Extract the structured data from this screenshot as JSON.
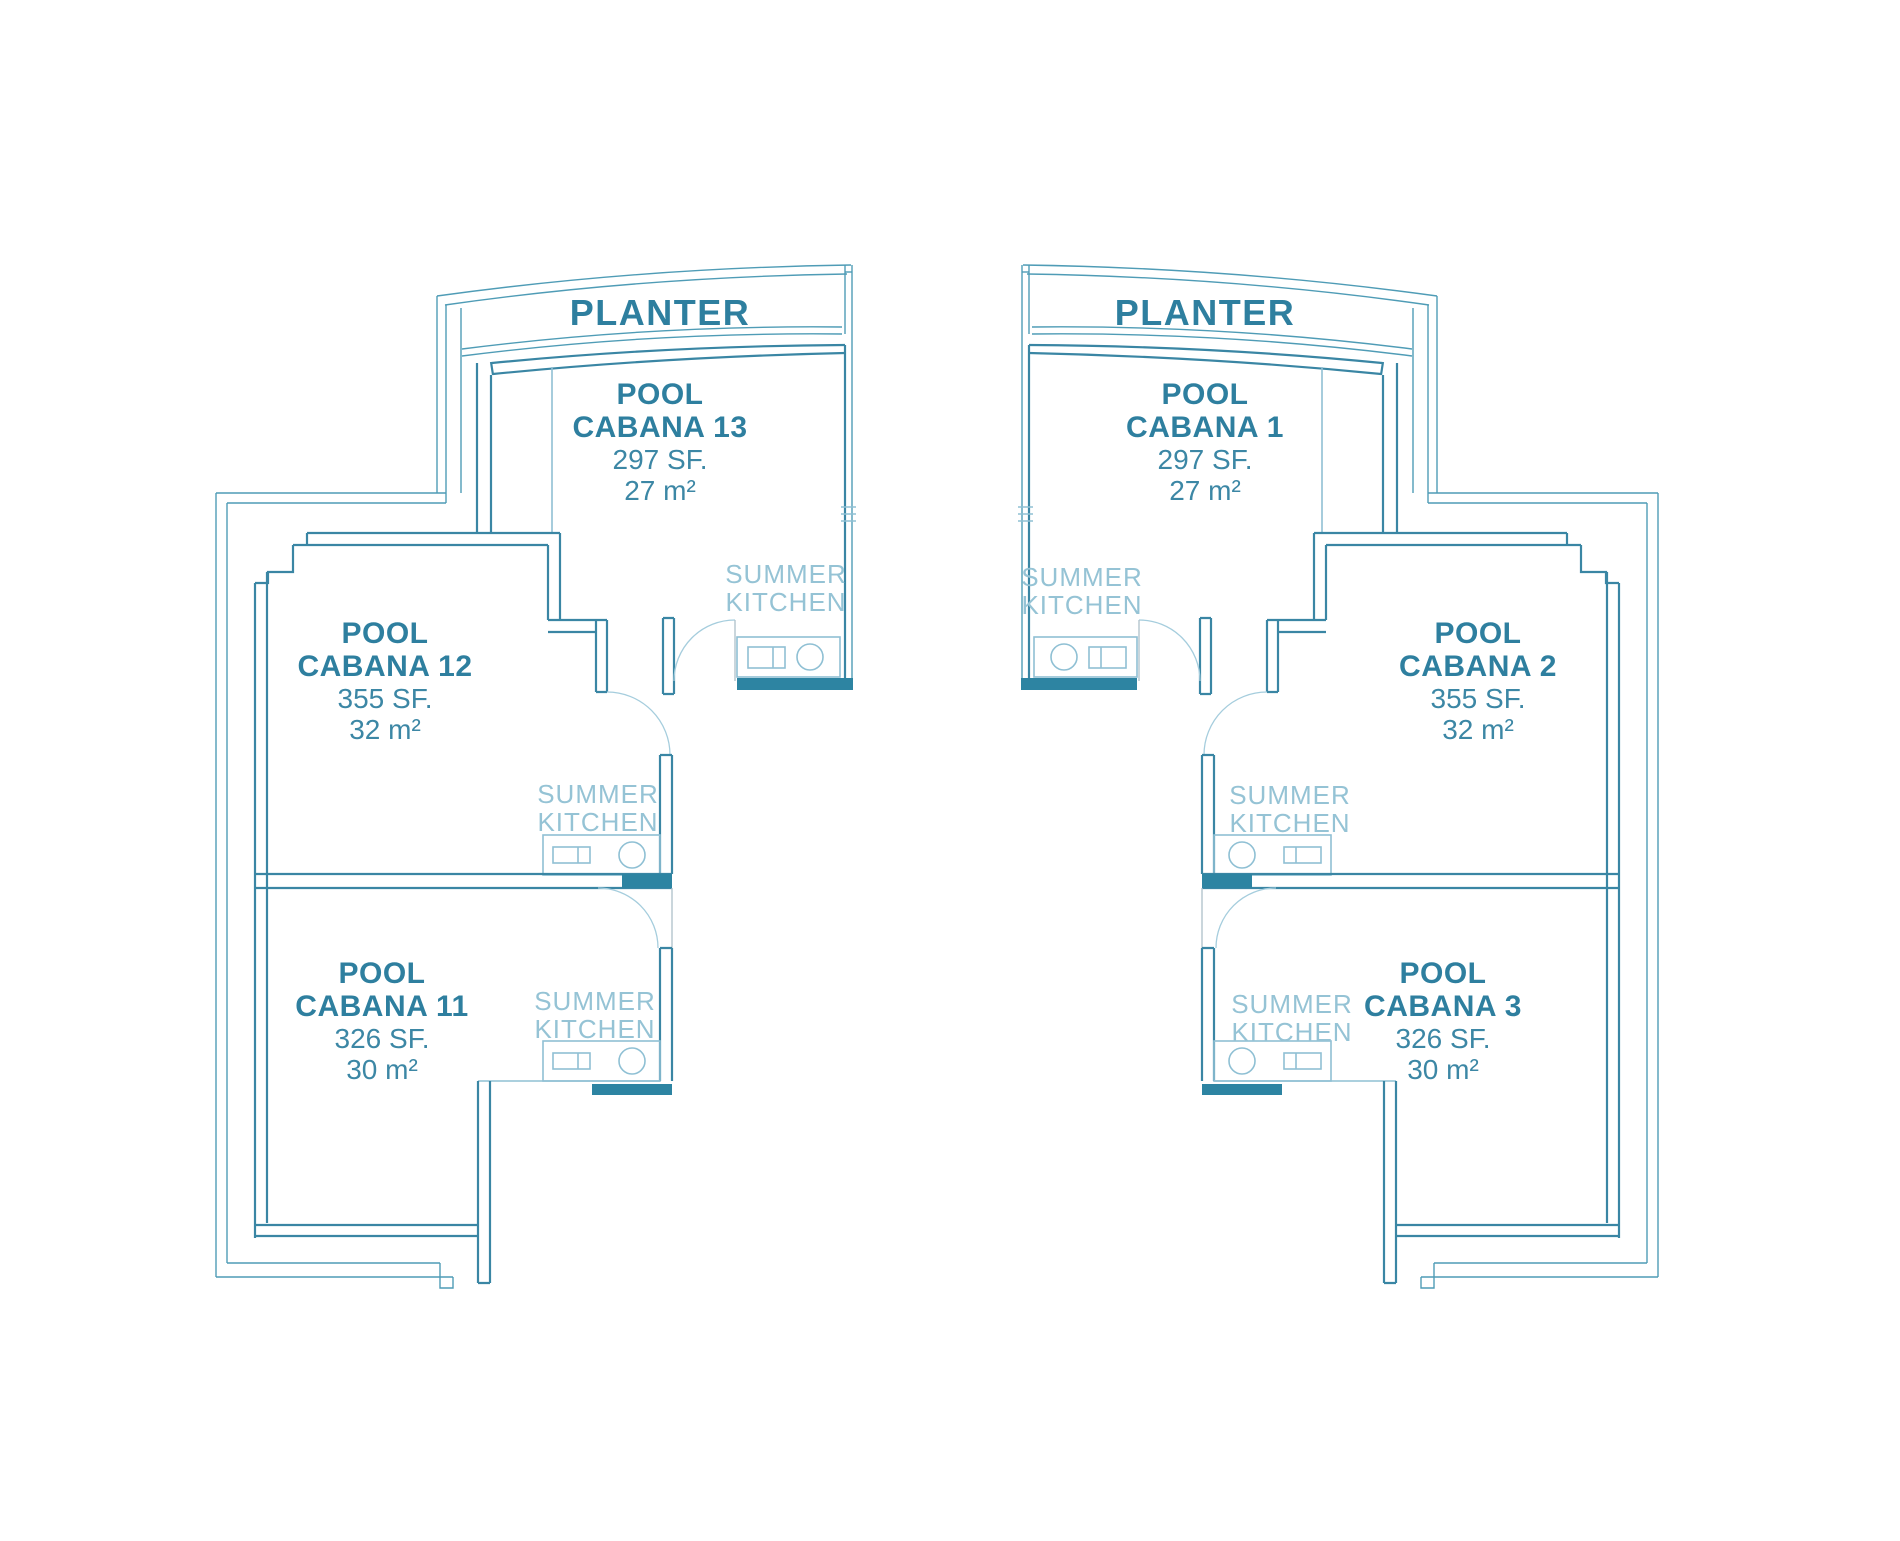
{
  "colors": {
    "wall": "#3a86a4",
    "wall_dark_fill": "#2d84a2",
    "outer_boundary": "#4f9cb6",
    "fixture_light": "#8fc0d4",
    "door_arc": "#a5cddd",
    "label_bold": "#2e7f9f",
    "label_number": "#3c87a5",
    "label_kitchen": "#95c3d5",
    "background": "#ffffff"
  },
  "summer_kitchen": {
    "line1": "SUMMER",
    "line2": "KITCHEN"
  },
  "plans": {
    "left": {
      "planter": "PLANTER",
      "cabanas": [
        {
          "line1": "POOL",
          "line2": "CABANA 13",
          "sf": "297 SF.",
          "m2": "27 m²"
        },
        {
          "line1": "POOL",
          "line2": "CABANA 12",
          "sf": "355 SF.",
          "m2": "32 m²"
        },
        {
          "line1": "POOL",
          "line2": "CABANA 11",
          "sf": "326 SF.",
          "m2": "30 m²"
        }
      ]
    },
    "right": {
      "planter": "PLANTER",
      "cabanas": [
        {
          "line1": "POOL",
          "line2": "CABANA 1",
          "sf": "297 SF.",
          "m2": "27 m²"
        },
        {
          "line1": "POOL",
          "line2": "CABANA 2",
          "sf": "355 SF.",
          "m2": "32 m²"
        },
        {
          "line1": "POOL",
          "line2": "CABANA 3",
          "sf": "326 SF.",
          "m2": "30 m²"
        }
      ]
    }
  }
}
